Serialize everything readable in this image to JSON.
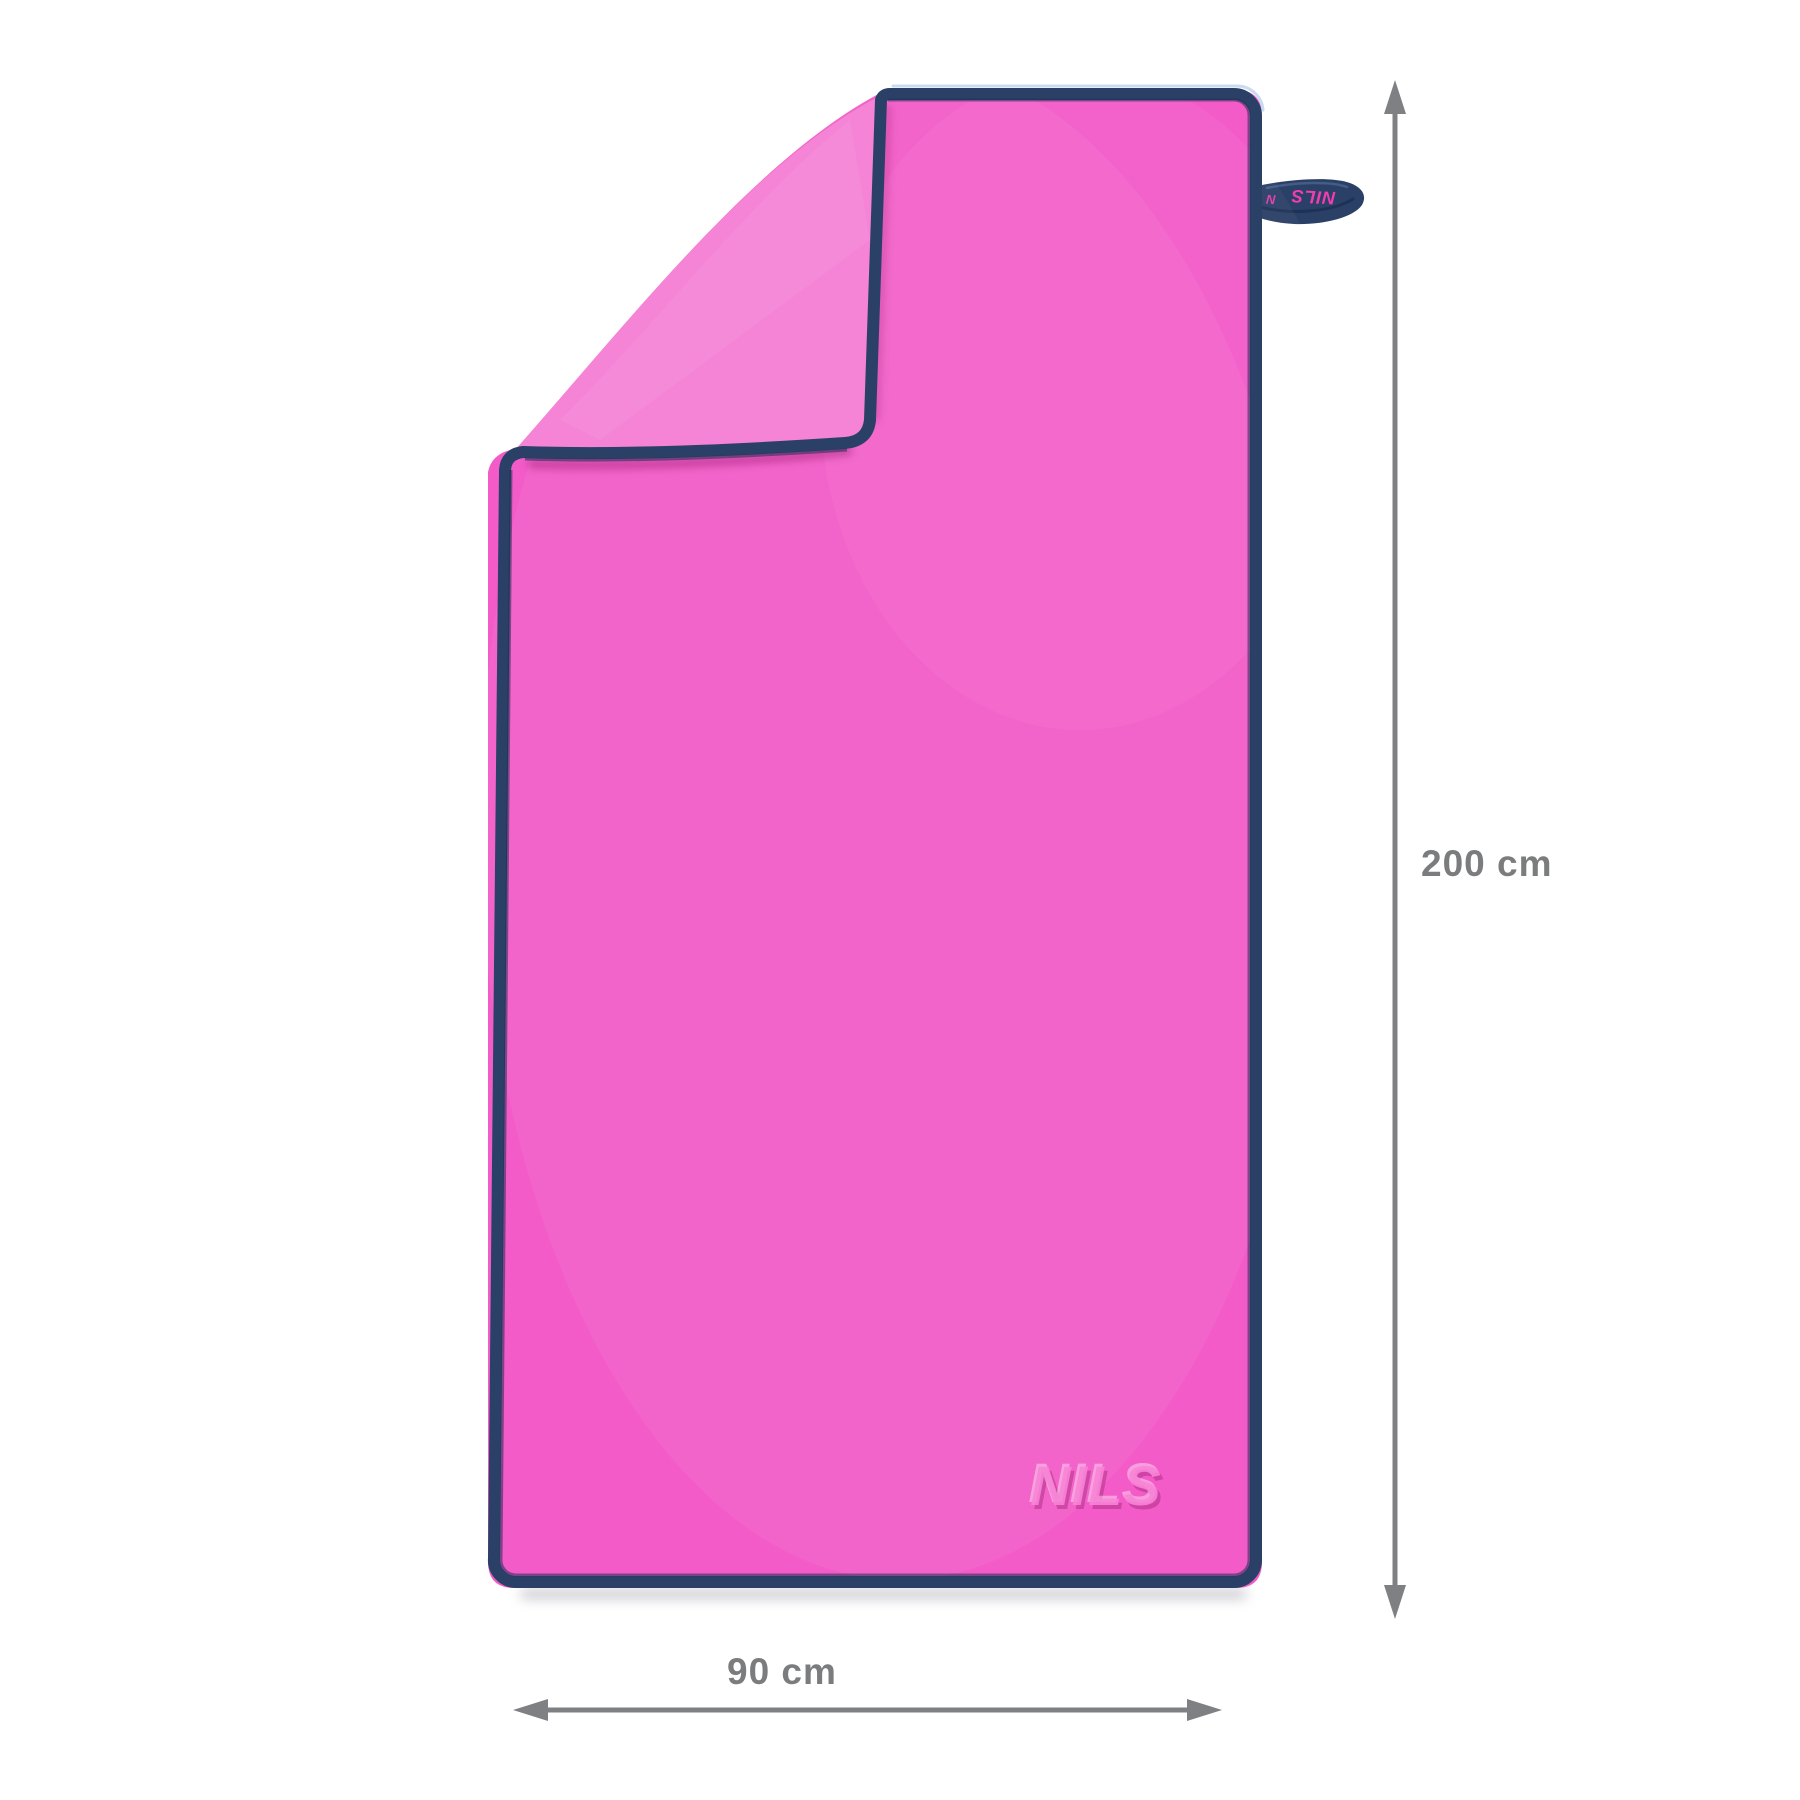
{
  "product": {
    "embossed_logo": "NILS",
    "loop_tag_text": "NILS",
    "loop_tag_fragment": "N"
  },
  "dimensions": {
    "height_label": "200 cm",
    "width_label": "90 cm"
  },
  "colors": {
    "background": "#ffffff",
    "towel_front_pink": "#f35cc8",
    "towel_back_pink": "#f583d6",
    "trim_navy": "#2b4066",
    "trim_navy_dark": "#1d3052",
    "trim_highlight_blue": "#bed5ee",
    "loop_text_pink": "#f23dae",
    "embossed_logo_pink": "#fa84d8",
    "dimension_gray": "#7e8083"
  }
}
